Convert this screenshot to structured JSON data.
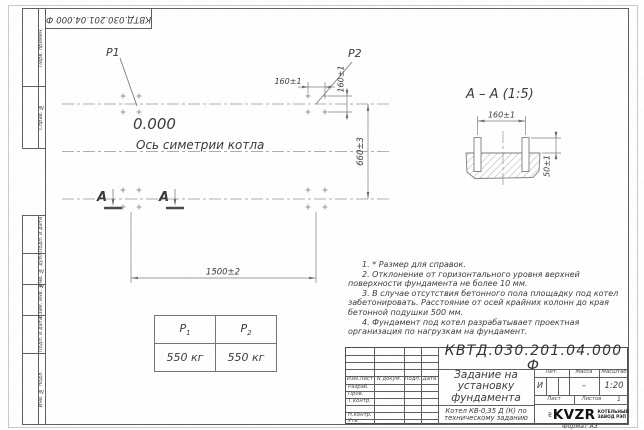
{
  "doc_number": "КВТД.030.201.04.000 Ф",
  "format_label": "Формат А3",
  "margin_columns": {
    "top": [
      "Перв. примен.",
      "Справ. №"
    ],
    "bottom": [
      "Подп. и дата",
      "Инв. № дубл.",
      "Взам. инв. №",
      "Подп. и дата",
      "Инв. № подл."
    ]
  },
  "plan": {
    "p1_label": "P1",
    "p2_label": "P2",
    "elevation": "0.000",
    "axis_label": "Ось симетрии котла",
    "section_letter": "А",
    "dim_overall_width": "1500±2",
    "dim_overall_height": "660±3",
    "dim_bolt_spacing_x": "160±1",
    "dim_bolt_spacing_y": "160±1"
  },
  "section_view": {
    "title": "А – А (1:5)",
    "dim_bolt_spacing": "160±1",
    "dim_protrusion": "50±1"
  },
  "notes": [
    "1. * Размер для справок.",
    "2. Отклонение от горизонтального уровня верхней поверхности фундамента не более 10 мм.",
    "3. В случае отсутствия бетонного пола площадку под котел забетонировать. Расстояние от осей крайних колонн до края бетонной подушки 500 мм.",
    "4. Фундамент под котел разрабатывает проектная организация по нагрузкам на фундамент."
  ],
  "load_table": {
    "headers": [
      {
        "sym": "P",
        "sub": "1"
      },
      {
        "sym": "P",
        "sub": "2"
      }
    ],
    "values": [
      "550 кг",
      "550 кг"
    ]
  },
  "title_block": {
    "title_line1": "Задание на",
    "title_line2": "установку",
    "title_line3": "фундамента",
    "desc_line1": "Котел КВ-0,35 Д (К) по",
    "desc_line2": "техническому заданию",
    "col_headers": [
      "Изм.Лист",
      "N докум.",
      "Подп.",
      "Дата"
    ],
    "row_labels": [
      "Разраб.",
      "Пров.",
      "Т.контр.",
      "",
      "Н.контр.",
      "Утв."
    ],
    "lit_label": "Лит.",
    "mass_label": "Масса",
    "scale_label": "Масштаб",
    "lit_value": "И",
    "mass_value": "–",
    "scale_value": "1:20",
    "sheet_label": "Лист",
    "sheets_label": "Листов",
    "sheets_value": "1",
    "logo_text": "KVZR",
    "logo_caption1": "КОТЕЛЬНЫЙ",
    "logo_caption2": "ЗАВОД РЭП"
  }
}
